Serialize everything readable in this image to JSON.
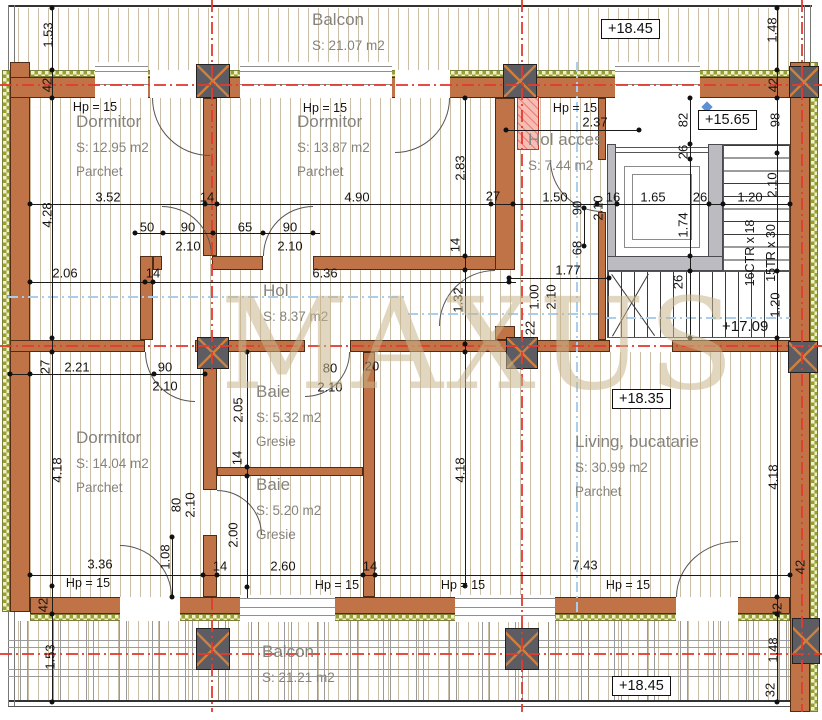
{
  "watermark": "MAXUS",
  "hp": "Hp = 15",
  "rooms": {
    "balcon_top": {
      "name": "Balcon",
      "area": "S: 21.07 m2"
    },
    "dormitor1": {
      "name": "Dormitor",
      "area": "S: 12.95 m2",
      "finish": "Parchet"
    },
    "dormitor2": {
      "name": "Dormitor",
      "area": "S: 13.87 m2",
      "finish": "Parchet"
    },
    "hol_acces": {
      "name": "Hol acces",
      "area": "S: 7.44 m2"
    },
    "hol": {
      "name": "Hol",
      "area": "S: 8.37 m2"
    },
    "dormitor3": {
      "name": "Dormitor",
      "area": "S: 14.04 m2",
      "finish": "Parchet"
    },
    "baie1": {
      "name": "Baie",
      "area": "S: 5.32 m2",
      "finish": "Gresie"
    },
    "baie2": {
      "name": "Baie",
      "area": "S: 5.20 m2",
      "finish": "Gresie"
    },
    "living": {
      "name": "Living, bucatarie",
      "area": "S: 30.99 m2",
      "finish": "Parchet"
    },
    "balcon_bottom": {
      "name": "Balcon",
      "area": "S: 21.21 m2"
    }
  },
  "levels": {
    "top_right": "+18.45",
    "landing": "+15.65",
    "stairs": "+17.09",
    "living": "+18.35",
    "bottom_right": "+18.45"
  },
  "stairs": {
    "note1": "16CTR x 18",
    "note2": "15TR x 30"
  },
  "dims": [
    "1.53",
    "42",
    "4.28",
    "2.06",
    "27",
    "2.21",
    "4.18",
    "3.36",
    "42",
    "1.53",
    "1.48",
    "42",
    "3.52",
    "14",
    "4.90",
    "27",
    "1.50",
    "16",
    "1.65",
    "26",
    "1.20",
    "2.37",
    "2.83",
    "82",
    "98",
    "26",
    "90",
    "2.10",
    "50",
    "65",
    "90",
    "2.10",
    "90",
    "2.10",
    "2.10",
    "1.74",
    "26",
    "1.20",
    "68",
    "14",
    "14",
    "6.36",
    "1.77",
    "1.32",
    "1.00",
    "2.10",
    "22",
    "90",
    "2.10",
    "80",
    "2.10",
    "20",
    "2.05",
    "14",
    "2.00",
    "80",
    "2.10",
    "4.18",
    "4.18",
    "1.08",
    "14",
    "2.60",
    "14",
    "7.43",
    "42",
    "42",
    "1.48",
    "32"
  ]
}
